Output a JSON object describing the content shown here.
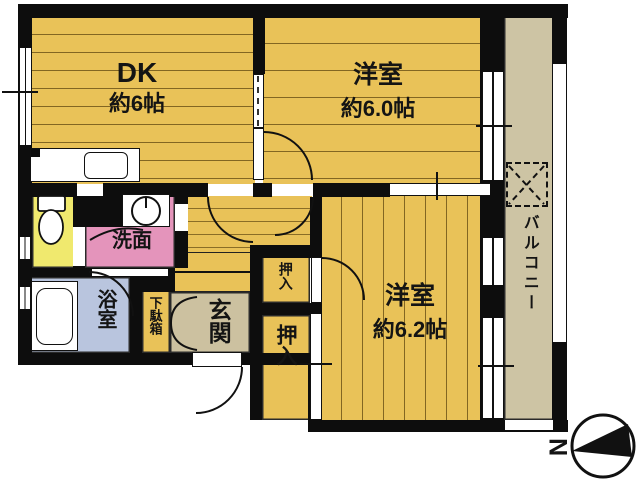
{
  "meta": {
    "type": "apartment-floor-plan",
    "style": "japanese-madori",
    "layout_hint": "2DK"
  },
  "rooms": {
    "dk": {
      "name": "DK",
      "size": "約6帖"
    },
    "bedroom1": {
      "name": "洋室",
      "size": "約6.0帖"
    },
    "bedroom2": {
      "name": "洋室",
      "size": "約6.2帖"
    },
    "washroom": {
      "name": "洗面"
    },
    "bathroom": {
      "name": "浴室"
    },
    "entrance": {
      "name": "玄関"
    },
    "shoe_cabinet": {
      "name": "下駄箱"
    },
    "closet_small": {
      "name": "押入"
    },
    "closet_large": {
      "name": "押入"
    },
    "balcony": {
      "name": "バルコニー"
    }
  },
  "fixtures": {
    "kitchen_sink": "sink",
    "toilet": "toilet",
    "bathtub": "bathtub",
    "washing_machine": "washing-machine",
    "washer_pan_balcony": "outdoor-washer-pan"
  },
  "compass": {
    "label": "N",
    "direction": "north-left"
  },
  "colors": {
    "floor": "#e9c258",
    "toilet_room": "#f0e96e",
    "washroom": "#e494bb",
    "bathroom": "#b9c5de",
    "entrance": "#ccc1a0",
    "balcony": "#cdc4a4",
    "wall": "#0d0d0d"
  }
}
